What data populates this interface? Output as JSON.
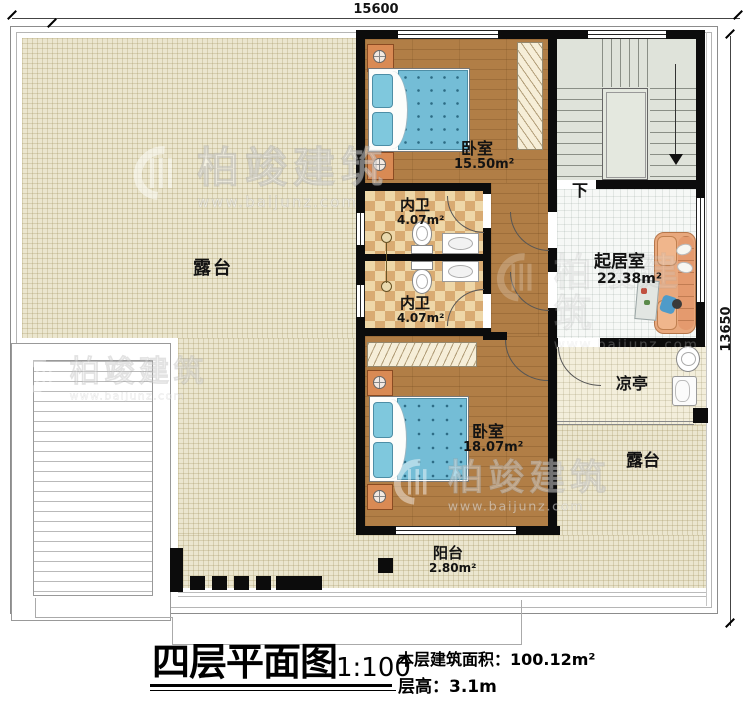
{
  "dimensions": {
    "top": "15600",
    "right": "13650"
  },
  "rooms": {
    "terrace_main": {
      "label": "露台"
    },
    "terrace_lower": {
      "label": "露台"
    },
    "bedroom_top": {
      "label": "卧室",
      "area": "15.50m²"
    },
    "bedroom_bottom": {
      "label": "卧室",
      "area": "18.07m²"
    },
    "bath_top": {
      "label": "内卫",
      "area": "4.07m²"
    },
    "bath_bottom": {
      "label": "内卫",
      "area": "4.07m²"
    },
    "living_room": {
      "label": "起居室",
      "area": "22.38m²"
    },
    "pavilion": {
      "label": "凉亭"
    },
    "balcony": {
      "label": "阳台",
      "area": "2.80m²"
    },
    "stairs": {
      "direction_label": "下"
    }
  },
  "title_block": {
    "title": "四层平面图",
    "scale": "1:100",
    "floor_area_label": "本层建筑面积：",
    "floor_area_value": "100.12m²",
    "floor_height_label": "层高：",
    "floor_height_value": "3.1m"
  },
  "watermark": {
    "brand": "柏竣建筑",
    "url": "www.baijunz.com"
  },
  "colors": {
    "terrace_tile": "#ebe6cf",
    "wood_floor": "#b17e46",
    "bath_checker_light": "#eed7a8",
    "bath_checker_dark": "#d9ab72",
    "living_tile": "#f6f8f6",
    "pavilion_tile": "#f3eedb",
    "stair_fill": "#dfe3da",
    "wall": "#0c0c0c",
    "bed_blue": "#74bdd6",
    "nightstand_orange": "#d98a54",
    "sofa_salmon": "#e8a87d"
  }
}
